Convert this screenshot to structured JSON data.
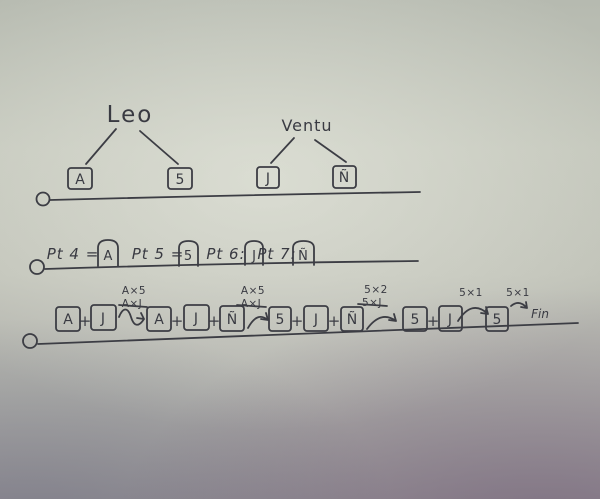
{
  "paper": {
    "ink_color": "#3c3d44"
  },
  "tree_section": {
    "trees": [
      {
        "name": "Leo",
        "children": [
          "A",
          "5"
        ]
      },
      {
        "name": "Ventu",
        "children": [
          "J",
          "Ñ"
        ]
      }
    ]
  },
  "points_section": {
    "items": [
      {
        "label": "Pt 4 =",
        "value": "A"
      },
      {
        "label": "Pt 5 =",
        "value": "5"
      },
      {
        "label": "Pt 6:",
        "value": "J"
      },
      {
        "label": "Pt 7:",
        "value": "Ñ"
      }
    ]
  },
  "steps_section": {
    "plus": "+",
    "groups": [
      [
        "A",
        "J"
      ],
      [
        "A",
        "J",
        "Ñ"
      ],
      [
        "5",
        "J",
        "Ñ"
      ],
      [
        "5",
        "J"
      ],
      [
        "5"
      ]
    ],
    "transitions": [
      {
        "label": "A×5",
        "crossed_out": "A×J"
      },
      {
        "label": "A×5",
        "crossed_out": "A×J"
      },
      {
        "label": "5×2",
        "crossed_out": "5×J"
      },
      {
        "label": "5×1"
      },
      {
        "label": "5×1"
      }
    ],
    "end_label": "Fin"
  }
}
